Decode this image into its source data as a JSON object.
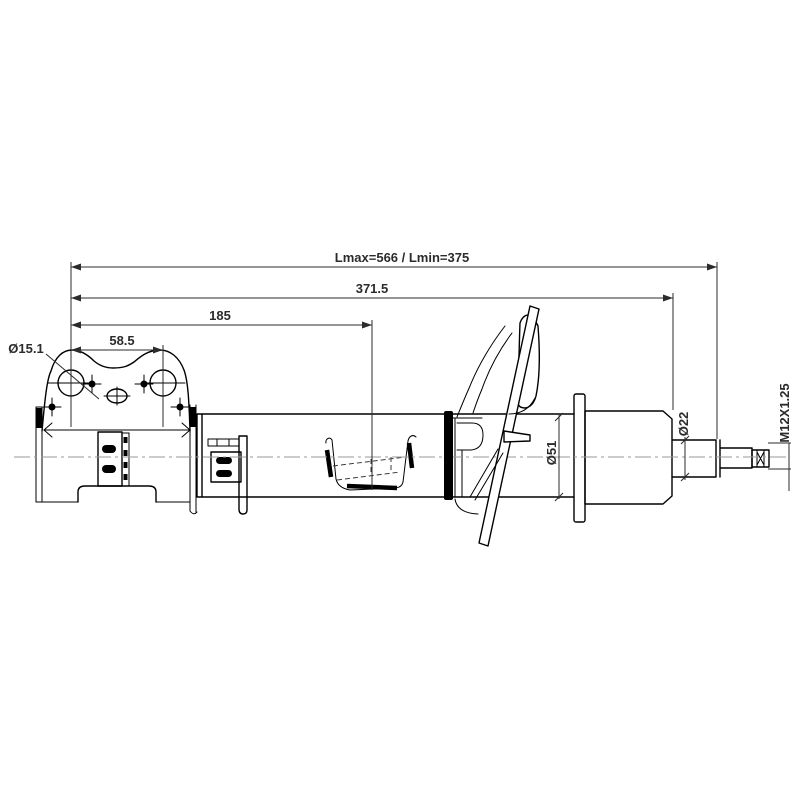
{
  "labels": {
    "length_overall": "Lmax=566 / Lmin=375",
    "dim_371_5": "371.5",
    "dim_185": "185",
    "dim_58_5": "58.5",
    "hole_diameter": "Ø15.1",
    "body_diameter": "Ø51",
    "rod_diameter": "Ø22",
    "thread_spec": "M12X1.25"
  },
  "colors": {
    "outline": "#000000",
    "dimension": "#2b2b2b",
    "centerline": "#9a9a9a",
    "background": "#ffffff"
  }
}
